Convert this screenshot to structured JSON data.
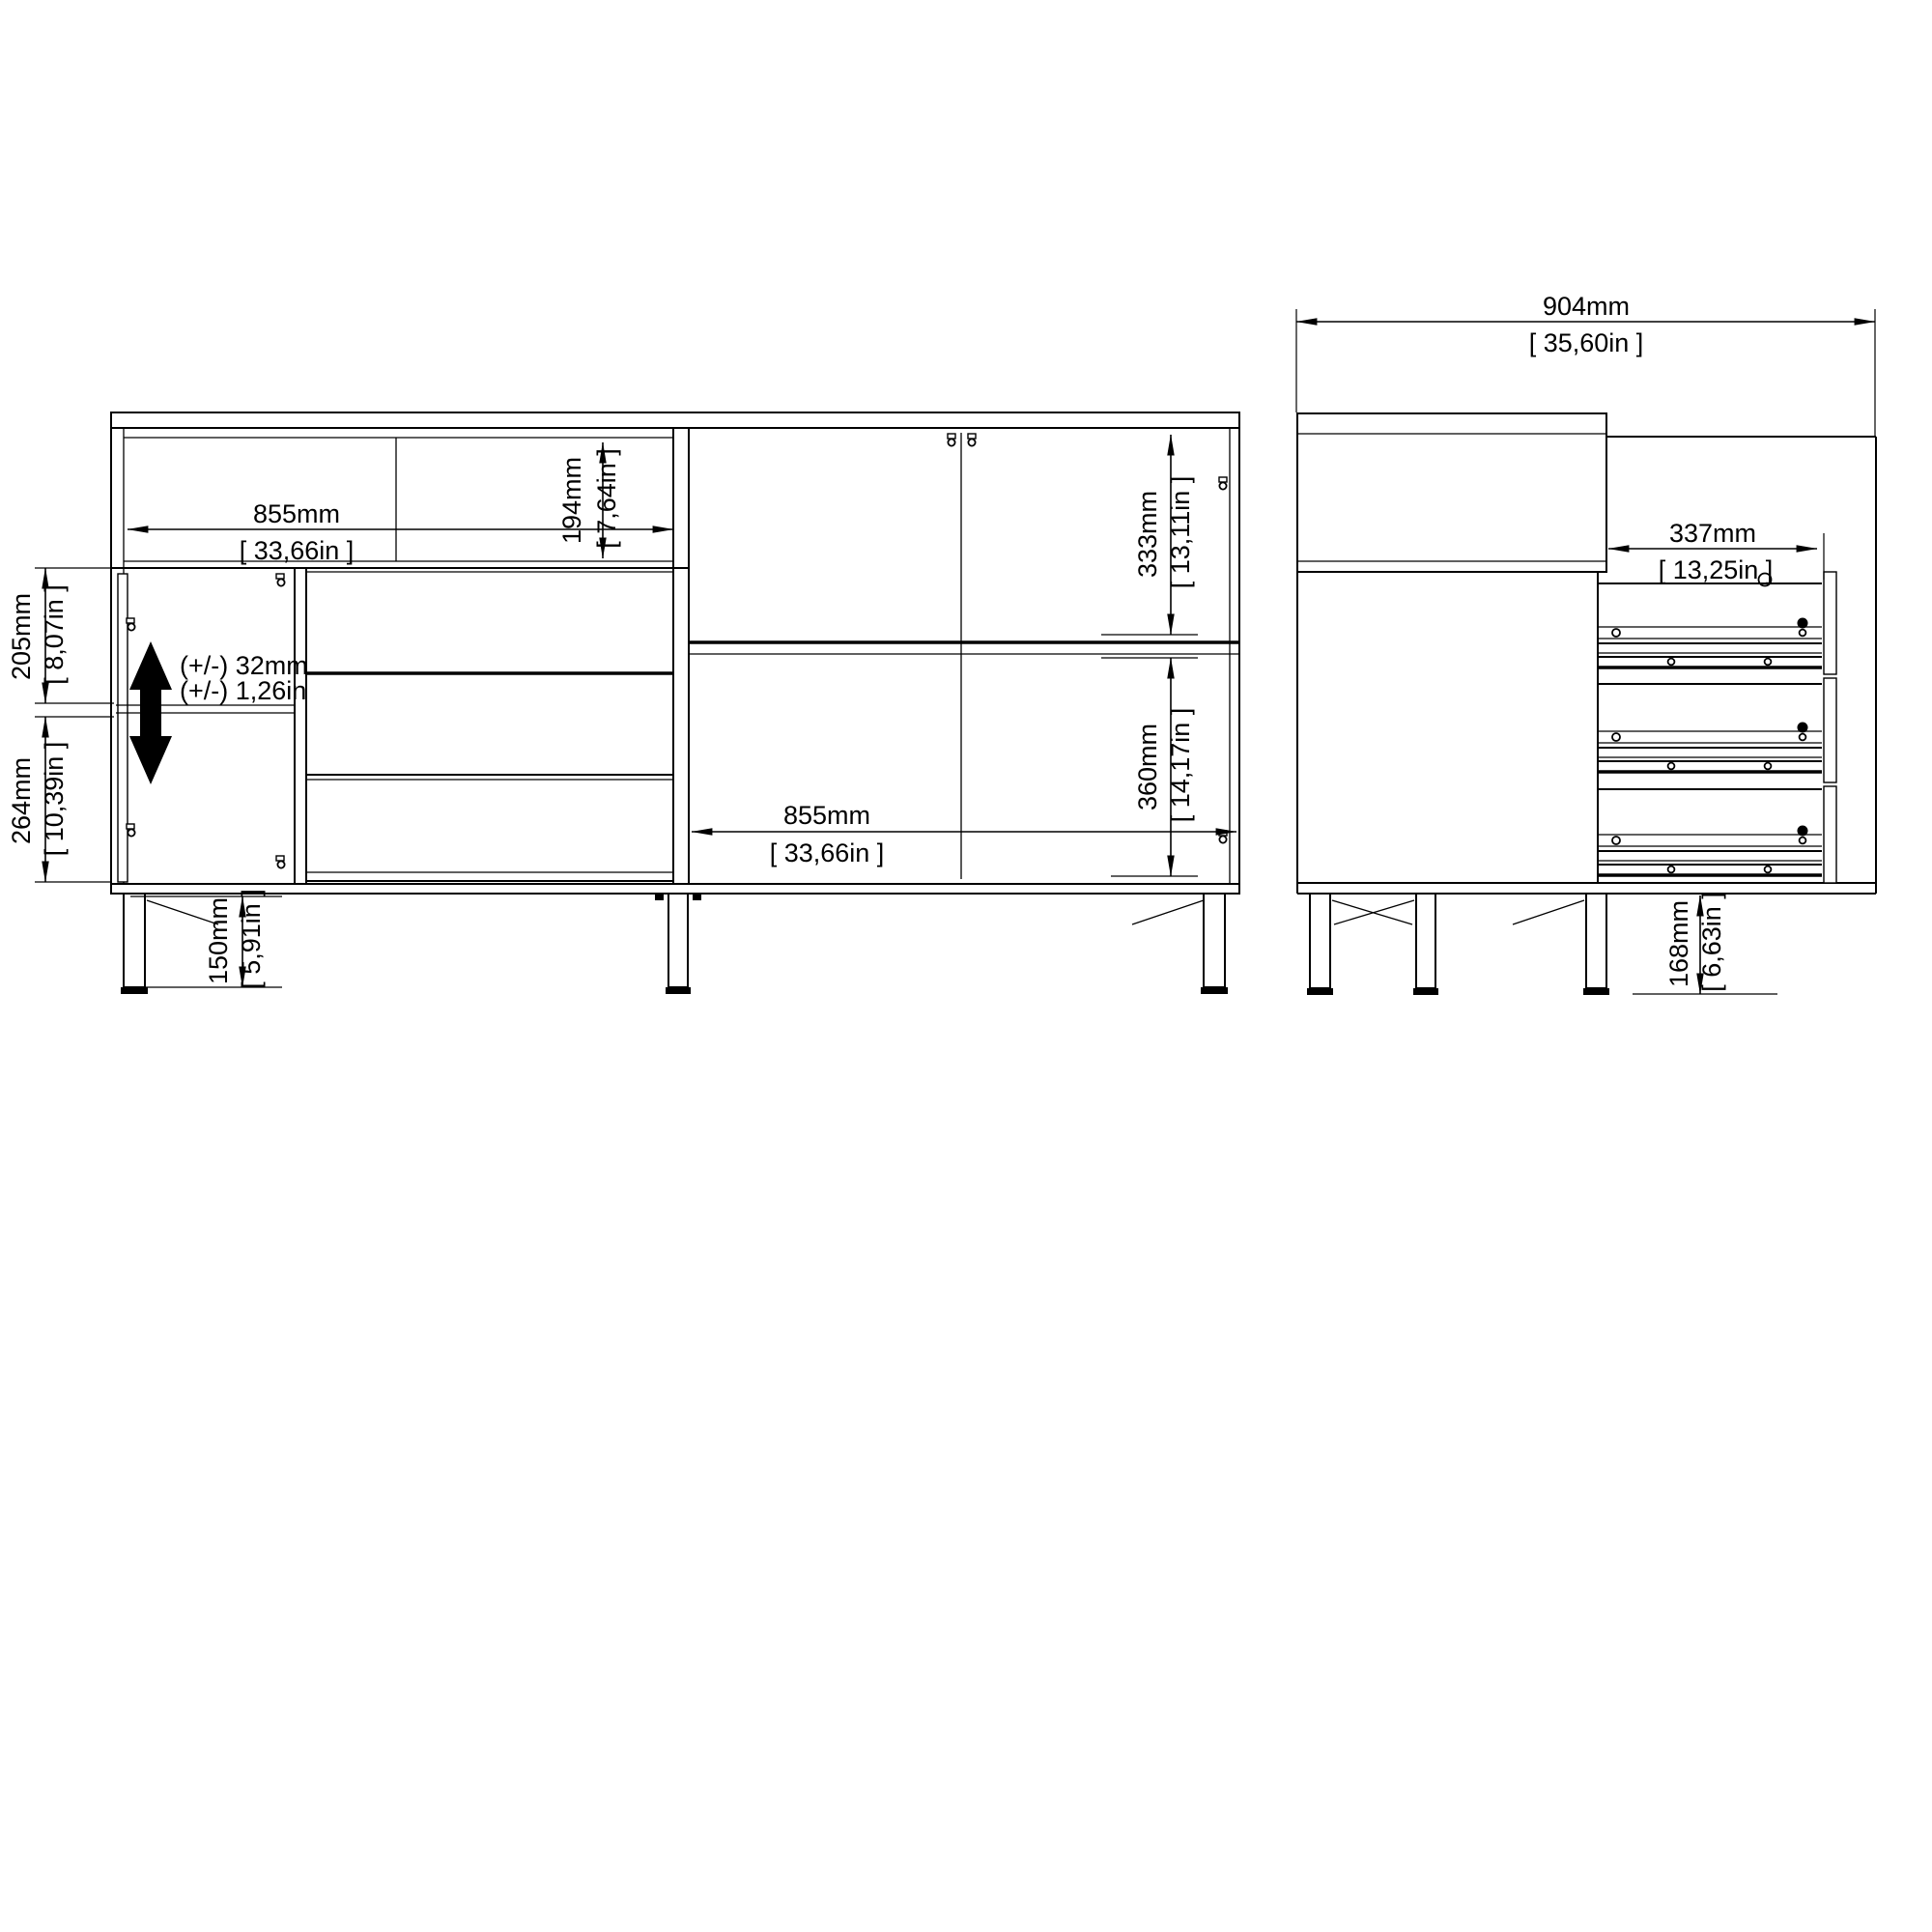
{
  "document": {
    "type": "furniture-assembly-dimension-drawing",
    "background": "#ffffff",
    "line_color": "#000000"
  },
  "front_view": {
    "dimensions": {
      "top_section_width": {
        "mm": "855mm",
        "in": "[ 33,66in ]"
      },
      "top_shelf_height": {
        "mm": "194mm",
        "in": "[ 7,64in ]"
      },
      "left_upper_compartment": {
        "mm": "205mm",
        "in": "[ 8,07in ]"
      },
      "left_lower_compartment": {
        "mm": "264mm",
        "in": "[ 10,39in ]"
      },
      "shelf_adjustment": {
        "mm": "(+/-) 32mm",
        "in": "(+/-) 1,26in"
      },
      "leg_height": {
        "mm": "150mm",
        "in": "[ 5,91in ]"
      },
      "right_upper_compartment": {
        "mm": "333mm",
        "in": "[ 13,11in ]"
      },
      "right_lower_compartment": {
        "mm": "360mm",
        "in": "[ 14,17in ]"
      },
      "right_section_width": {
        "mm": "855mm",
        "in": "[ 33,66in ]"
      }
    }
  },
  "side_view": {
    "dimensions": {
      "total_width": {
        "mm": "904mm",
        "in": "[ 35,60in ]"
      },
      "drawer_width": {
        "mm": "337mm",
        "in": "[ 13,25in ]"
      },
      "leg_height": {
        "mm": "168mm",
        "in": "[ 6,63in ]"
      }
    }
  },
  "icons": {
    "shelf_adjust": "vertical-double-arrow"
  }
}
